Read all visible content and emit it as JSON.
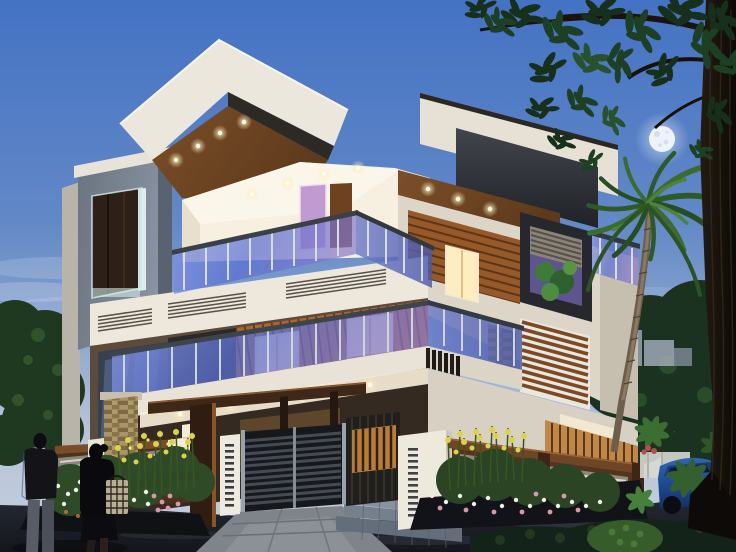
{
  "scene": {
    "description": "Dusk architectural rendering of a modern three-storey house with glass balconies, wood cladding, recessed ceiling lights, a landscaped front yard with yellow and white flowers, an entrance gate, a palm tree, a large foreground tree trunk, a full moon in a blue evening sky, a parked blue car and two pedestrians walking past",
    "time_of_day": "dusk",
    "moon_phase": "full",
    "people_count": 2,
    "objects": [
      "evening sky",
      "full moon",
      "background trees",
      "distant buildings",
      "modern house",
      "roof slab with wood soffit",
      "recessed ceiling lights",
      "glass balconies",
      "wood plank cladding",
      "charcoal planter window box",
      "louvre screen",
      "stone veneer column",
      "entrance pergola",
      "slatted gate",
      "white slotted pillars",
      "compound wall with louvre windows",
      "staircase",
      "flower beds",
      "palm tree",
      "foreground tree trunk",
      "driveway",
      "paved walkway",
      "tiled steps",
      "parked blue car",
      "two pedestrians",
      "handbag"
    ]
  },
  "palette": {
    "sky_top": "#4472c4",
    "sky_mid": "#6288c6",
    "sky_horizon": "#b7c4d9",
    "moon": "#eef2fa",
    "wall_white": "#ece7dd",
    "wall_cream": "#e7e1d5",
    "interior_cream": "#f7efdf",
    "charcoal": "#26282d",
    "wood_soffit": "#7c4f28",
    "wood_planks": "#aa6830",
    "wood_fence": "#6e4526",
    "glass_blue": "#5a6fd2",
    "glass_purple": "#8878cc",
    "window_glow": "#ffedc2",
    "purple_door": "#c09ad0",
    "foliage_dark": "#1b3220",
    "foliage_light": "#3c6e34",
    "flower_yellow": "#ddd34a",
    "flower_white": "#eeeee6",
    "flower_pink": "#d898aa",
    "road": "#14161c",
    "paving": "#7f838a",
    "car_blue": "#2e66b8",
    "silhouette": "#0d0d11"
  }
}
